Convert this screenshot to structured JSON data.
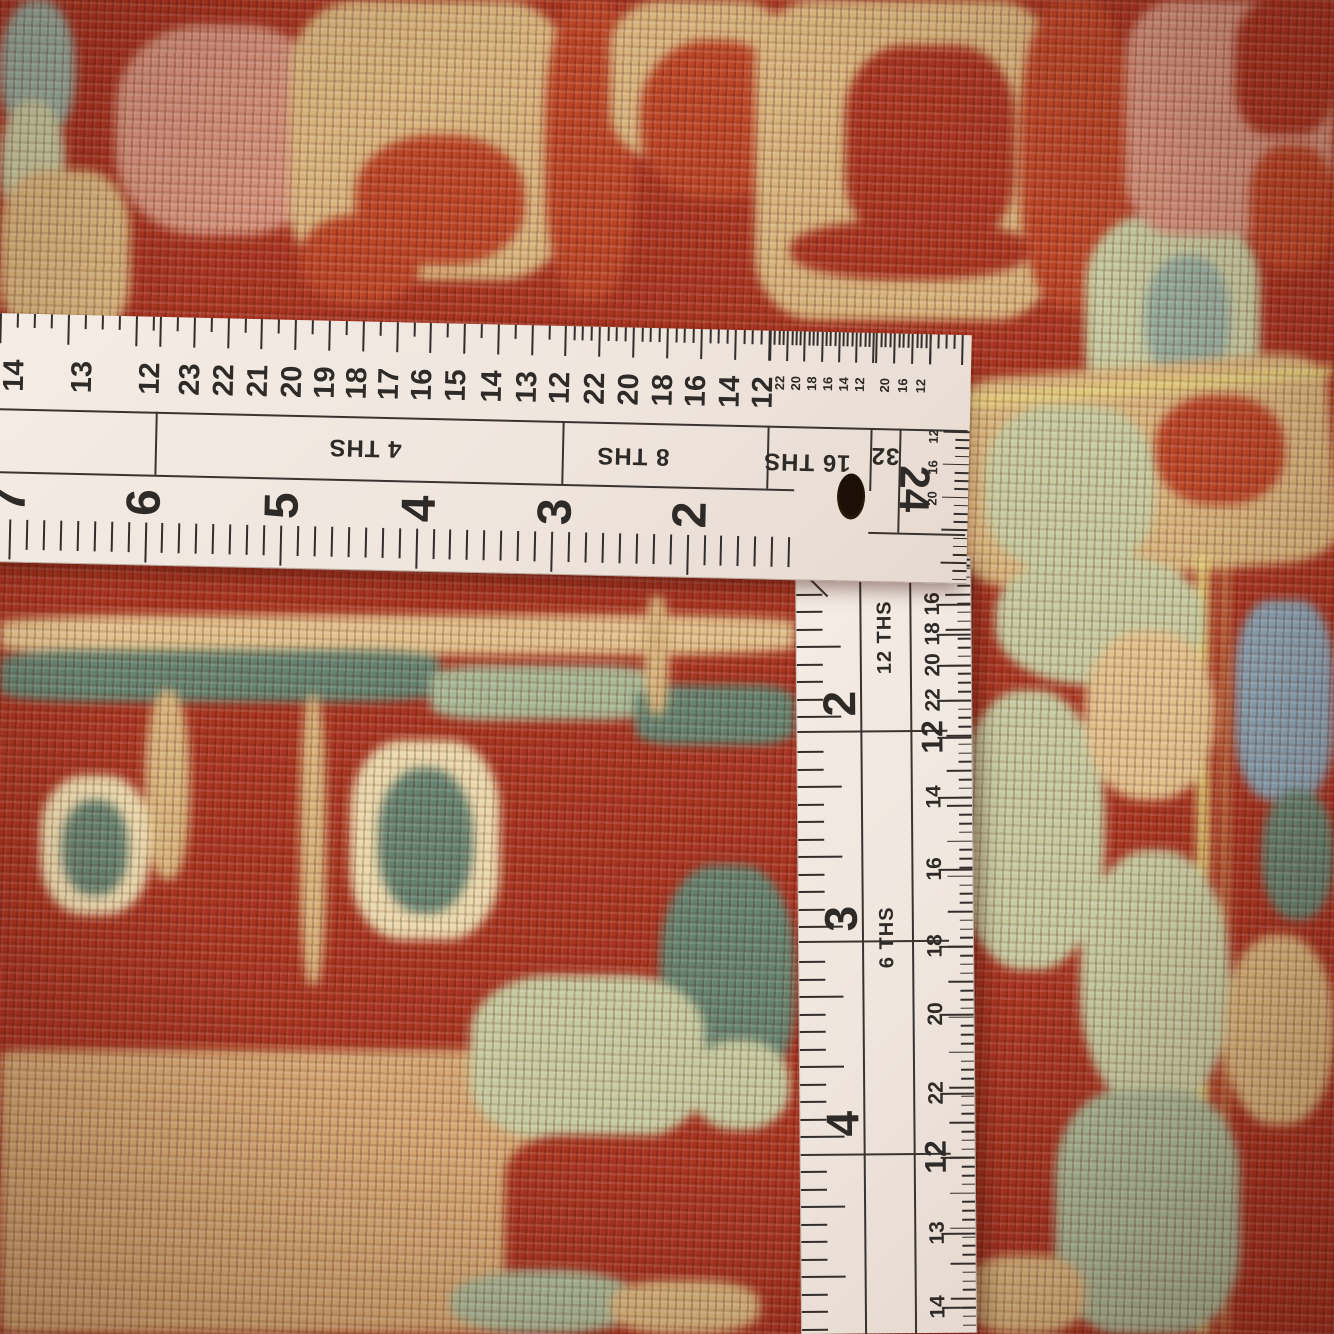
{
  "colors": {
    "red": "#a93421",
    "red2": "#bc4527",
    "dred": "#8e2a18",
    "tan": "#d8b47c",
    "tan2": "#e2c18c",
    "camel": "#d5a873",
    "salmon": "#d4917a",
    "sage": "#c6cba0",
    "sage2": "#a8b896",
    "teal": "#64826f",
    "bgreen": "#95ad9e",
    "blue": "#87a0b0",
    "cream": "#ead9ad",
    "yellow": "#e5d47c",
    "ruler_white": "#f2e9e2",
    "ink": "#332e2b"
  },
  "ruler": {
    "horizontal": {
      "top_comb": [
        {
          "x0": 8,
          "x1": 168,
          "step": 17,
          "longEvery": 4
        },
        {
          "x0": 168,
          "x1": 573,
          "step": 16.9,
          "longEvery": 2
        },
        {
          "x0": 573,
          "x1": 778,
          "step": 8.5,
          "longEvery": 4
        },
        {
          "x0": 778,
          "x1": 884,
          "step": 4.3,
          "longEvery": 4
        },
        {
          "x0": 884,
          "x1": 938,
          "step": 4.5,
          "longEvery": 4
        },
        {
          "x0": 938,
          "x1": 974,
          "step": 8,
          "longEvery": 4
        }
      ],
      "top_numbers": [
        {
          "t": "14",
          "x": 24,
          "s": "m"
        },
        {
          "t": "13",
          "x": 92,
          "s": "m"
        },
        {
          "t": "12",
          "x": 160,
          "s": "m"
        },
        {
          "t": "23",
          "x": 200,
          "s": "m"
        },
        {
          "t": "22",
          "x": 234,
          "s": "m"
        },
        {
          "t": "21",
          "x": 268,
          "s": "m"
        },
        {
          "t": "20",
          "x": 302,
          "s": "m"
        },
        {
          "t": "19",
          "x": 335,
          "s": "m"
        },
        {
          "t": "18",
          "x": 367,
          "s": "m"
        },
        {
          "t": "17",
          "x": 399,
          "s": "m"
        },
        {
          "t": "16",
          "x": 432,
          "s": "m"
        },
        {
          "t": "15",
          "x": 466,
          "s": "m"
        },
        {
          "t": "14",
          "x": 502,
          "s": "m"
        },
        {
          "t": "13",
          "x": 537,
          "s": "m"
        },
        {
          "t": "12",
          "x": 570,
          "s": "m"
        },
        {
          "t": "22",
          "x": 605,
          "s": "m"
        },
        {
          "t": "20",
          "x": 639,
          "s": "m"
        },
        {
          "t": "18",
          "x": 673,
          "s": "m"
        },
        {
          "t": "16",
          "x": 706,
          "s": "m"
        },
        {
          "t": "14",
          "x": 740,
          "s": "m"
        },
        {
          "t": "12",
          "x": 773,
          "s": "m"
        },
        {
          "t": "22",
          "x": 789,
          "s": "t"
        },
        {
          "t": "20",
          "x": 805,
          "s": "t"
        },
        {
          "t": "18",
          "x": 821,
          "s": "t"
        },
        {
          "t": "16",
          "x": 837,
          "s": "t"
        },
        {
          "t": "14",
          "x": 853,
          "s": "t"
        },
        {
          "t": "12",
          "x": 869,
          "s": "t"
        },
        {
          "t": "20",
          "x": 894,
          "s": "t"
        },
        {
          "t": "16",
          "x": 912,
          "s": "t"
        },
        {
          "t": "12",
          "x": 930,
          "s": "t"
        }
      ],
      "band": {
        "y_top": 95,
        "y_bottom": 158,
        "dividers": [
          166,
          573,
          778,
          881
        ],
        "labels": [
          {
            "t": "4 THS",
            "x": 376,
            "y": 126
          },
          {
            "t": "8 THS",
            "x": 644,
            "y": 128
          },
          {
            "t": "16 THS",
            "x": 818,
            "y": 130
          },
          {
            "t": "32",
            "x": 896,
            "y": 122
          }
        ]
      },
      "hole": {
        "x": 863,
        "y": 164
      },
      "corner": {
        "n24": {
          "t": "24",
          "x": 926,
          "y": 155
        },
        "mini_x": 944,
        "mini_numbers": [
          {
            "t": "12",
            "y": 102
          },
          {
            "t": "16",
            "y": 133
          },
          {
            "t": "20",
            "y": 164
          }
        ],
        "vline_x": 910,
        "hline_y": 199,
        "comb": {
          "x": 952,
          "y0": 96,
          "y1": 246,
          "step": 8.2,
          "longEvery": 4
        }
      },
      "big_numbers": [
        {
          "t": "7",
          "x": 22
        },
        {
          "t": "6",
          "x": 157
        },
        {
          "t": "5",
          "x": 295
        },
        {
          "t": "4",
          "x": 432
        },
        {
          "t": "3",
          "x": 568
        },
        {
          "t": "2",
          "x": 703
        }
      ],
      "big_y": 186,
      "bottom_comb": {
        "x0": 22,
        "x1": 806,
        "step": 16.94,
        "top": 206,
        "long": 40,
        "short": 30
      }
    },
    "vertical": {
      "left_comb": {
        "y0": 18,
        "y1": 772,
        "step": 17.5,
        "longEvery": 4,
        "long": 44,
        "short": 26
      },
      "major_lines": [
        173,
        383,
        596
      ],
      "dividers": [
        63,
        113
      ],
      "labels": [
        {
          "t": "12 THS",
          "y": 80
        },
        {
          "t": "6 THS",
          "y": 380
        }
      ],
      "label_x": 88,
      "big_numbers": [
        {
          "t": "2",
          "y": 146
        },
        {
          "t": "3",
          "y": 361
        },
        {
          "t": "4",
          "y": 566
        }
      ],
      "big_x": 42,
      "right_numbers": [
        {
          "t": "14",
          "y": 8
        },
        {
          "t": "16",
          "y": 47
        },
        {
          "t": "18",
          "y": 77
        },
        {
          "t": "20",
          "y": 108
        },
        {
          "t": "22",
          "y": 143
        },
        {
          "t": "12",
          "y": 180,
          "big": true
        },
        {
          "t": "14",
          "y": 240
        },
        {
          "t": "16",
          "y": 312
        },
        {
          "t": "18",
          "y": 389
        },
        {
          "t": "20",
          "y": 457
        },
        {
          "t": "22",
          "y": 536
        },
        {
          "t": "12",
          "y": 600,
          "big": true
        },
        {
          "t": "13",
          "y": 676
        },
        {
          "t": "14",
          "y": 750
        }
      ],
      "right_num_x": 136,
      "right_comb": {
        "y0": 2,
        "y1": 772,
        "step": 8.8,
        "longEvery": 4,
        "long": 25,
        "short": 13
      }
    }
  },
  "carpet": {
    "blobs": [
      [
        0,
        0,
        75,
        140,
        "bgreen",
        45
      ],
      [
        0,
        100,
        65,
        130,
        "sage",
        45
      ],
      [
        0,
        170,
        130,
        170,
        "tan",
        35
      ],
      [
        115,
        25,
        215,
        210,
        "salmon",
        40
      ],
      [
        290,
        0,
        280,
        280,
        "tan",
        25
      ],
      [
        355,
        135,
        170,
        130,
        "red2",
        45
      ],
      [
        300,
        215,
        120,
        90,
        "red2",
        45
      ],
      [
        545,
        0,
        90,
        300,
        "red2",
        40
      ],
      [
        610,
        0,
        180,
        160,
        "tan",
        30
      ],
      [
        640,
        40,
        150,
        160,
        "red2",
        45
      ],
      [
        755,
        0,
        300,
        320,
        "tan",
        20
      ],
      [
        845,
        45,
        170,
        200,
        "red",
        35
      ],
      [
        790,
        220,
        240,
        60,
        "red",
        45
      ],
      [
        1020,
        0,
        110,
        310,
        "red2",
        40
      ],
      [
        1085,
        215,
        175,
        205,
        "sage",
        35
      ],
      [
        1145,
        255,
        85,
        125,
        "bgreen",
        45
      ],
      [
        1125,
        0,
        209,
        235,
        "salmon",
        25
      ],
      [
        1235,
        0,
        99,
        135,
        "red",
        35
      ],
      [
        1250,
        145,
        84,
        125,
        "red2",
        40
      ],
      [
        955,
        365,
        379,
        210,
        "tan",
        15,
        -5
      ],
      [
        950,
        382,
        384,
        10,
        "yellow",
        0,
        -5
      ],
      [
        985,
        405,
        170,
        165,
        "sage",
        40
      ],
      [
        1155,
        395,
        130,
        110,
        "red2",
        45
      ],
      [
        1197,
        555,
        12,
        779,
        "yellow",
        0
      ],
      [
        1222,
        560,
        6,
        774,
        "yellow",
        0,
        0,
        0.6
      ],
      [
        995,
        555,
        210,
        130,
        "sage",
        45
      ],
      [
        955,
        690,
        150,
        280,
        "sage",
        45
      ],
      [
        1085,
        630,
        130,
        170,
        "tan2",
        45
      ],
      [
        1235,
        600,
        99,
        200,
        "blue",
        35
      ],
      [
        1262,
        790,
        72,
        130,
        "teal",
        45
      ],
      [
        1080,
        850,
        150,
        260,
        "sage",
        45
      ],
      [
        1225,
        935,
        109,
        190,
        "tan",
        45
      ],
      [
        1055,
        1090,
        185,
        244,
        "sage2",
        35
      ],
      [
        965,
        1255,
        120,
        79,
        "tan",
        40
      ],
      [
        0,
        615,
        795,
        40,
        "tan2",
        20
      ],
      [
        0,
        650,
        440,
        52,
        "teal",
        20
      ],
      [
        430,
        665,
        225,
        55,
        "sage2",
        25
      ],
      [
        635,
        685,
        160,
        60,
        "teal",
        25
      ],
      [
        300,
        695,
        26,
        290,
        "tan",
        40
      ],
      [
        645,
        595,
        24,
        120,
        "tan",
        40
      ],
      [
        145,
        690,
        45,
        190,
        "tan",
        45
      ],
      [
        40,
        775,
        110,
        140,
        "cream",
        40
      ],
      [
        62,
        800,
        66,
        95,
        "teal",
        45
      ],
      [
        350,
        740,
        150,
        200,
        "cream",
        35
      ],
      [
        378,
        768,
        95,
        145,
        "teal",
        45
      ],
      [
        660,
        865,
        135,
        230,
        "teal",
        40
      ],
      [
        690,
        1040,
        100,
        90,
        "sage",
        45
      ],
      [
        0,
        1050,
        570,
        284,
        "camel",
        3
      ],
      [
        470,
        975,
        235,
        165,
        "sage",
        35
      ],
      [
        505,
        1135,
        290,
        199,
        "red",
        20
      ],
      [
        450,
        1270,
        190,
        64,
        "sage2",
        45
      ],
      [
        610,
        1280,
        150,
        54,
        "tan",
        40
      ]
    ]
  }
}
